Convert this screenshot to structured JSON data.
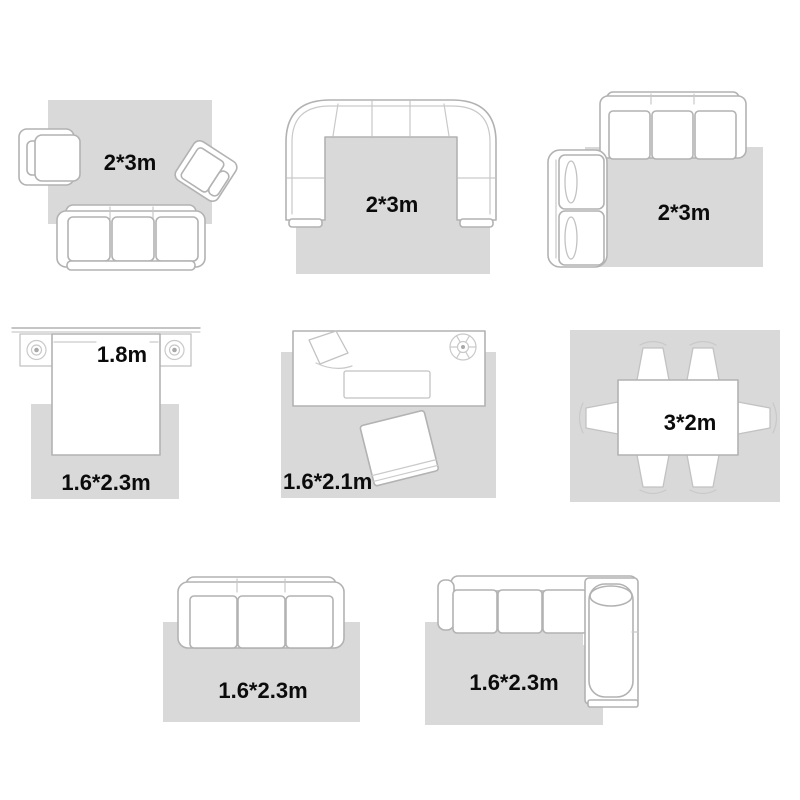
{
  "colors": {
    "background": "#ffffff",
    "rug": "#d9d9d9",
    "furniture_fill": "#ffffff",
    "furniture_outline": "#b2b2b2",
    "detail_line": "#c9c9c9",
    "label_text": "#0b0b0b"
  },
  "layouts": [
    {
      "name": "living-room-sofa-two-armchairs",
      "rug_size_label": "2*3m",
      "icons": [
        "rug",
        "armchair-icon",
        "tilted-armchair-icon",
        "three-seat-sofa-icon"
      ]
    },
    {
      "name": "living-room-u-sectional",
      "rug_size_label": "2*3m",
      "icons": [
        "rug",
        "u-sectional-sofa-icon"
      ]
    },
    {
      "name": "living-room-sofa-and-loveseat",
      "rug_size_label": "2*3m",
      "icons": [
        "rug",
        "three-seat-sofa-icon",
        "loveseat-icon"
      ]
    },
    {
      "name": "bedroom-bed-with-nightstands",
      "bed_width_label": "1.8m",
      "rug_size_label": "1.6*2.3m",
      "icons": [
        "rug",
        "bed-icon",
        "nightstand-lamp-icon",
        "nightstand-lamp-icon",
        "wall-line"
      ]
    },
    {
      "name": "office-desk-and-chair",
      "rug_size_label": "1.6*2.1m",
      "icons": [
        "rug",
        "desk-icon",
        "desk-lamp-icon",
        "keyboard-icon",
        "fan-icon",
        "tilted-chair-icon"
      ]
    },
    {
      "name": "dining-table-six-chairs",
      "table_size_label": "3*2m",
      "icons": [
        "rug",
        "dining-table-icon",
        "dining-chair-icon",
        "dining-chair-icon",
        "dining-chair-icon",
        "dining-chair-icon",
        "dining-chair-icon",
        "dining-chair-icon"
      ]
    },
    {
      "name": "three-seat-sofa",
      "rug_size_label": "1.6*2.3m",
      "icons": [
        "rug",
        "three-seat-sofa-icon"
      ]
    },
    {
      "name": "l-shaped-sectional-sofa",
      "rug_size_label": "1.6*2.3m",
      "icons": [
        "rug",
        "l-sectional-sofa-icon",
        "bolster-pillow-icon"
      ]
    }
  ]
}
